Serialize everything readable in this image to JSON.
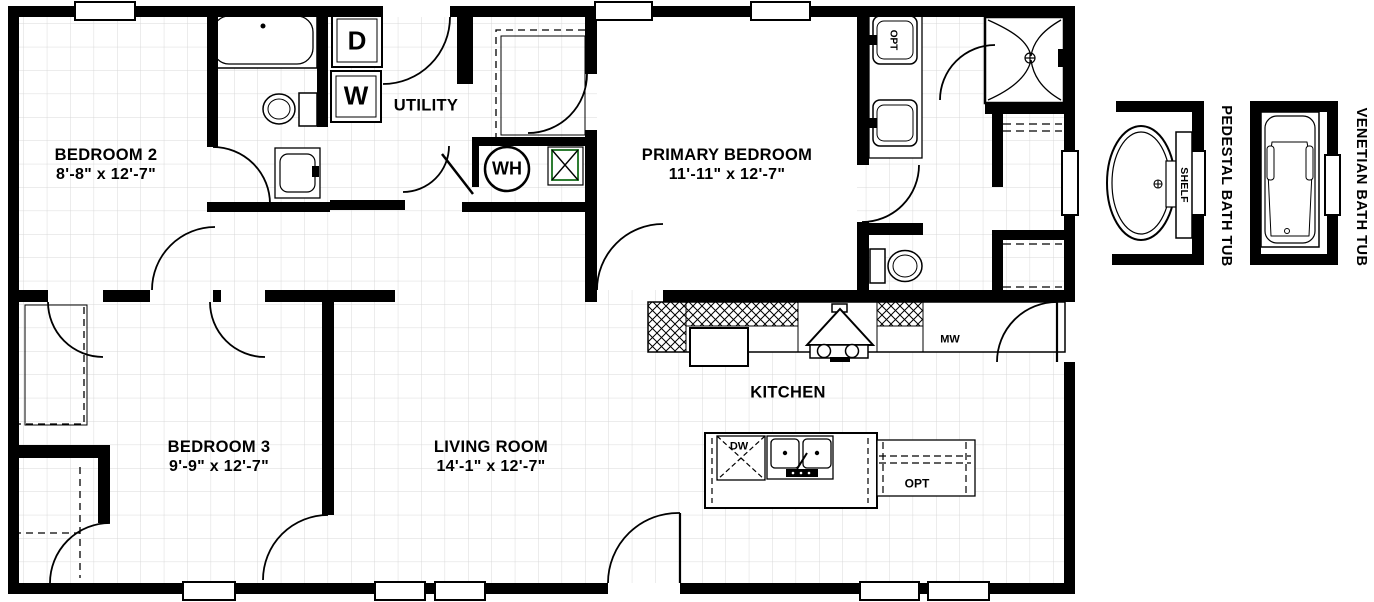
{
  "rooms": [
    {
      "name": "BEDROOM 2",
      "dims": "8'-8\" x 12'-7\""
    },
    {
      "name": "PRIMARY BEDROOM",
      "dims": "11'-11\" x 12'-7\""
    },
    {
      "name": "BEDROOM 3",
      "dims": "9'-9\" x 12'-7\""
    },
    {
      "name": "LIVING ROOM",
      "dims": "14'-1\" x 12'-7\""
    },
    {
      "name": "KITCHEN"
    },
    {
      "name": "UTILITY"
    }
  ],
  "fixtures": {
    "dryer": "D",
    "washer": "W",
    "water_heater": "WH",
    "microwave": "MW",
    "dishwasher": "DW",
    "island_option": "OPT",
    "sink_option": "OPT",
    "shelf": "SHELF"
  },
  "options": [
    {
      "label": "PEDESTAL BATH TUB"
    },
    {
      "label": "VENETIAN BATH TUB"
    }
  ],
  "colors": {
    "walls": "#000000",
    "grid": "#d9d9d9",
    "furnace_accent": "#2e7d32"
  }
}
